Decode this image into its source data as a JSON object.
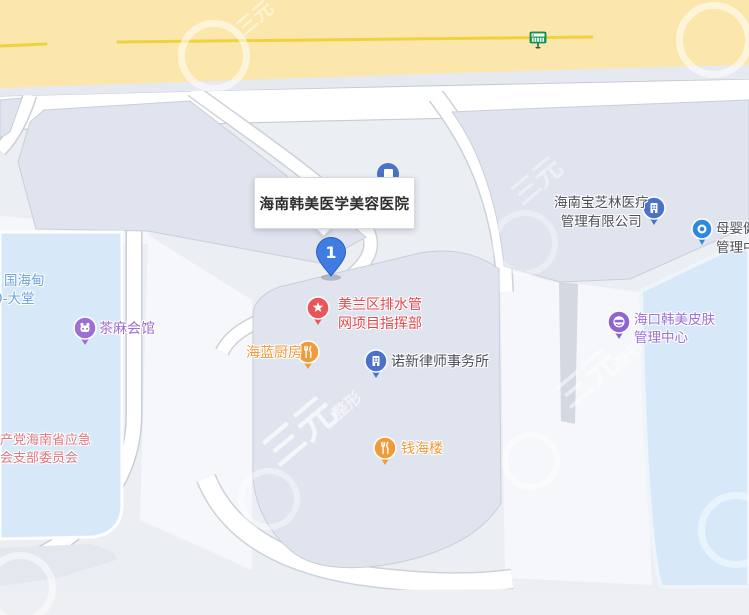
{
  "map": {
    "main_label": {
      "title": "海南韩美医学美容医院",
      "marker_number": "1"
    },
    "pois": [
      {
        "id": "haidian-hotel",
        "lines": [
          "国海甸",
          "0-大堂"
        ],
        "color": "#6BA3DD",
        "icon": null
      },
      {
        "id": "chama-club",
        "name": "茶麻会馆",
        "color": "#9C6FD5",
        "icon": "teahouse-pin"
      },
      {
        "id": "meilan-drainage",
        "lines": [
          "美兰区排水管",
          "网项目指挥部"
        ],
        "color": "#E2474B",
        "icon": "star-pin"
      },
      {
        "id": "hailan-kitchen",
        "name": "海蓝厨房",
        "color": "#EE9A3D",
        "icon": "restaurant-pin"
      },
      {
        "id": "nuoxin-lawfirm",
        "name": "诺新律师事务所",
        "color": "#4A4E57",
        "icon": "office-pin"
      },
      {
        "id": "emergency-committee",
        "lines": [
          "共产党海南省应急",
          "协会支部委员会"
        ],
        "color": "#E0777E",
        "icon": null
      },
      {
        "id": "qianhailou",
        "name": "钱海楼",
        "color": "#EE9A3D",
        "icon": "restaurant-pin"
      },
      {
        "id": "baozhilin-medical",
        "lines": [
          "海南宝芝林医疗",
          "管理有限公司"
        ],
        "color": "#4A4E57",
        "icon": "office-pin"
      },
      {
        "id": "muying-health",
        "lines": [
          "母婴健",
          "管理中"
        ],
        "color": "#4A4E57",
        "icon": "dot-pin"
      },
      {
        "id": "haikou-hanmei-skin",
        "lines": [
          "海口韩美皮肤",
          "管理中心"
        ],
        "color": "#9C6FD5",
        "icon": "face-pin"
      }
    ],
    "watermark": {
      "text": "三元",
      "subtext": "整形"
    },
    "transit": {
      "bus_stop": "bus-stop-icon"
    },
    "colors": {
      "highway_yellow": "#FBE6AB",
      "highway_centerline": "#EDD33E",
      "map_background": "#EBEEF3",
      "building_fill": "#E0E4EE",
      "water_blue_area": "#D7E9F8",
      "road_white": "#FFFFFF",
      "marker_blue": "#3F7DE3",
      "bus_green": "#12A55B",
      "poi_red": "#E2474B",
      "poi_orange": "#EE9A3D",
      "poi_purple": "#9C6FD5",
      "poi_blue": "#4B72C8",
      "poi_text_dark": "#4A4E57"
    }
  }
}
